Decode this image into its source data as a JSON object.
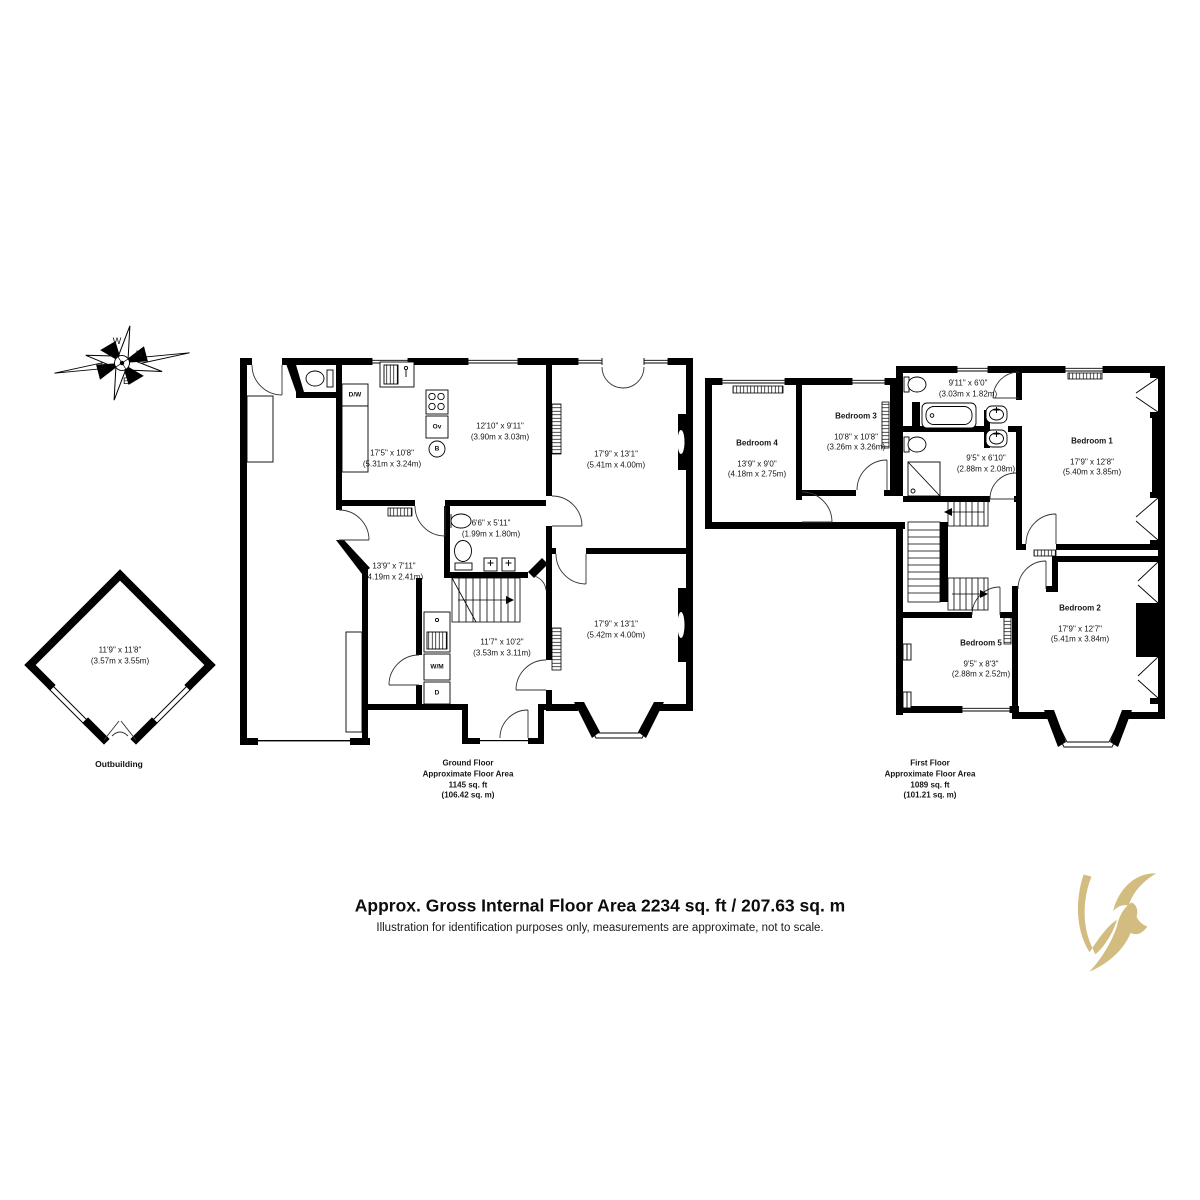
{
  "meta": {
    "footer_title": "Approx. Gross Internal Floor Area 2234 sq. ft / 207.63 sq. m",
    "footer_note": "Illustration for identification purposes only, measurements are approximate, not to scale."
  },
  "compass": {
    "n": "N",
    "e": "E",
    "s": "S",
    "w": "W"
  },
  "outbuilding": {
    "name": "Outbuilding",
    "dims": "11'9\" x 11'8\"\n(3.57m x 3.55m)"
  },
  "ground_floor": {
    "label": "Ground Floor\nApproximate Floor Area\n1145 sq. ft\n(106.42 sq. m)",
    "rooms": {
      "kitchen": {
        "dims": "17'5\" x 10'8\"\n(5.31m x 3.24m)"
      },
      "breakfast": {
        "dims": "12'10\" x 9'11\"\n(3.90m x 3.03m)"
      },
      "reception1": {
        "dims": "17'9\" x 13'1\"\n(5.41m x 4.00m)"
      },
      "reception2": {
        "dims": "17'9\" x 13'1\"\n(5.42m x 4.00m)"
      },
      "hall": {
        "dims": "13'9\" x 7'11\"\n(4.19m x 2.41m)"
      },
      "shower_room": {
        "dims": "6'6\" x 5'11\"\n(1.99m x 1.80m)"
      },
      "utility": {
        "dims": "11'7\" x 10'2\"\n(3.53m x 3.11m)"
      }
    },
    "fixtures": {
      "dw": "D/W",
      "ov": "Ov",
      "boiler": "B",
      "wm": "W/M",
      "dryer": "D"
    }
  },
  "first_floor": {
    "label": "First Floor\nApproximate Floor Area\n1089 sq. ft\n(101.21 sq. m)",
    "rooms": {
      "bedroom1": {
        "name": "Bedroom 1",
        "dims": "17'9\" x 12'8\"\n(5.40m x 3.85m)"
      },
      "bedroom2": {
        "name": "Bedroom 2",
        "dims": "17'9\" x 12'7\"\n(5.41m x 3.84m)"
      },
      "bedroom3": {
        "name": "Bedroom 3",
        "dims": "10'8\" x 10'8\"\n(3.26m x 3.26m)"
      },
      "bedroom4": {
        "name": "Bedroom 4",
        "dims": "13'9\" x 9'0\"\n(4.18m x 2.75m)"
      },
      "bedroom5": {
        "name": "Bedroom 5",
        "dims": "9'5\" x 8'3\"\n(2.88m x 2.52m)"
      },
      "bathroom": {
        "dims": "9'11\" x 6'0\"\n(3.03m x 1.82m)"
      },
      "shower_room": {
        "dims": "9'5\" x 6'10\"\n(2.88m x 2.08m)"
      }
    }
  },
  "colors": {
    "wall": "#000000",
    "logo_gold": "#d2bc80"
  }
}
